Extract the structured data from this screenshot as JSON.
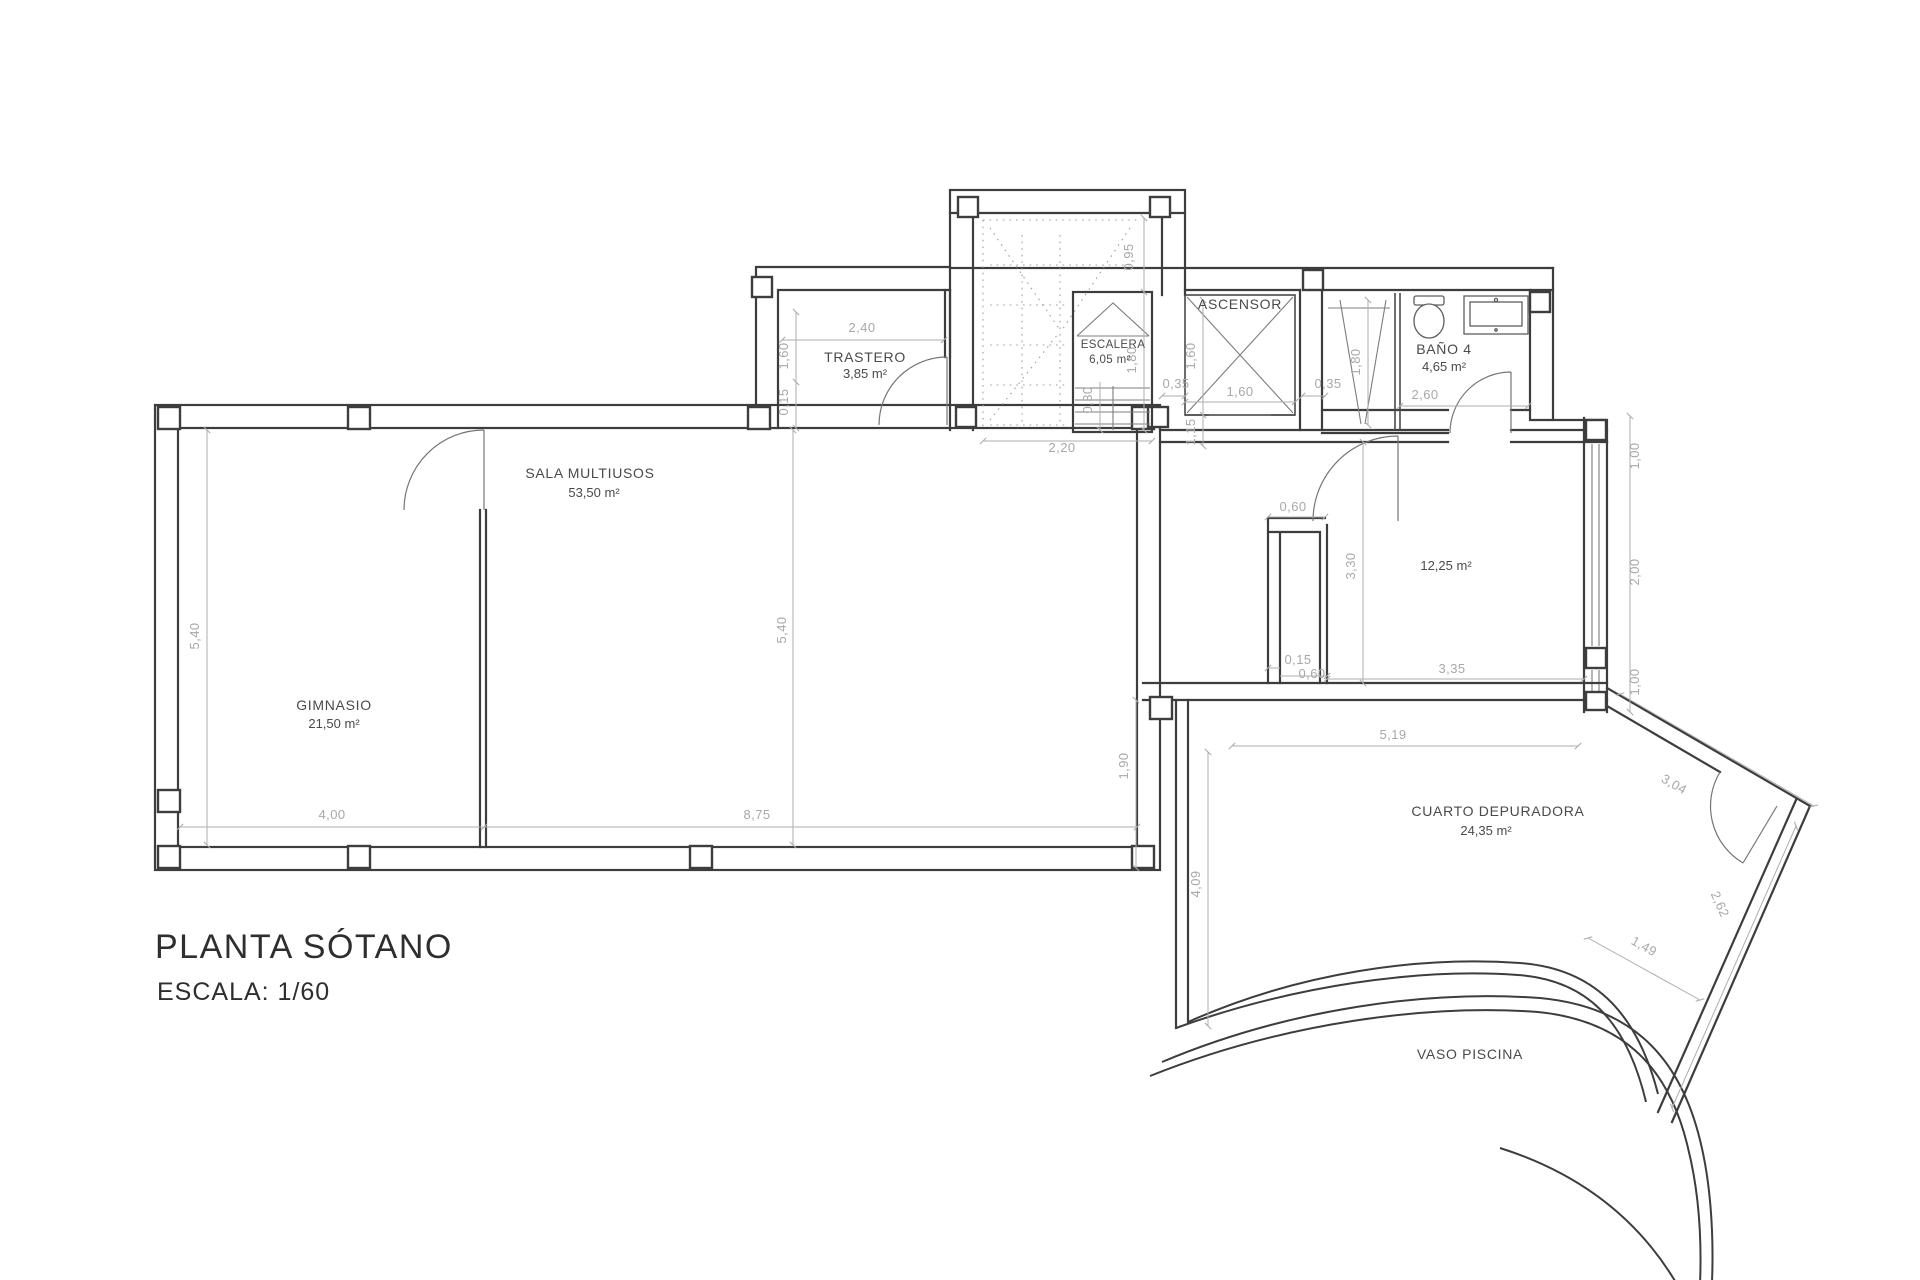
{
  "title": {
    "main": "PLANTA SÓTANO",
    "scale": "ESCALA: 1/60"
  },
  "colors": {
    "wall": "#3d3d3d",
    "dimension": "#a8a8a8",
    "label": "#4a4a4a",
    "background": "#ffffff"
  },
  "rooms": {
    "trastero": {
      "name": "TRASTERO",
      "area": "3,85 m²"
    },
    "sala_multiusos": {
      "name": "SALA MULTIUSOS",
      "area": "53,50 m²"
    },
    "gimnasio": {
      "name": "GIMNASIO",
      "area": "21,50 m²"
    },
    "escalera": {
      "name": "ESCALERA",
      "area": "6,05 m²"
    },
    "ascensor": {
      "name": "ASCENSOR"
    },
    "bano4": {
      "name": "BAÑO 4",
      "area": "4,65 m²"
    },
    "sala12": {
      "area": "12,25 m²"
    },
    "depuradora": {
      "name": "CUARTO DEPURADORA",
      "area": "24,35 m²"
    },
    "piscina": {
      "name": "VASO PISCINA"
    }
  },
  "dims": {
    "trastero_w": "2,40",
    "trastero_h": "1,60",
    "trastero_wall": "0,15",
    "stair_top": "0,95",
    "stair_w": "2,20",
    "esc_h": "1,80",
    "esc_step": "0,30",
    "asc_h": "1,60",
    "asc_w": "1,60",
    "asc_gap_l": "0,35",
    "asc_gap_r": "0,35",
    "asc_below": "1,15",
    "bano_shower": "1,80",
    "bano_w": "2,60",
    "win_top": "1,00",
    "win_mid": "2,00",
    "win_bot": "1,00",
    "notch_top": "0,60",
    "room12_h": "3,30",
    "notch_wall": "0,15",
    "notch_bot": "0,60",
    "room12_w": "3,35",
    "main_h_left": "5,40",
    "main_h_mid": "5,40",
    "gim_w": "4,00",
    "sala_w": "8,75",
    "dep_off": "1,90",
    "dep_top": "5,19",
    "dep_diag_top": "3,04",
    "dep_h": "4,09",
    "dep_diag_right": "2,62",
    "dep_diag_bot": "1,49"
  }
}
